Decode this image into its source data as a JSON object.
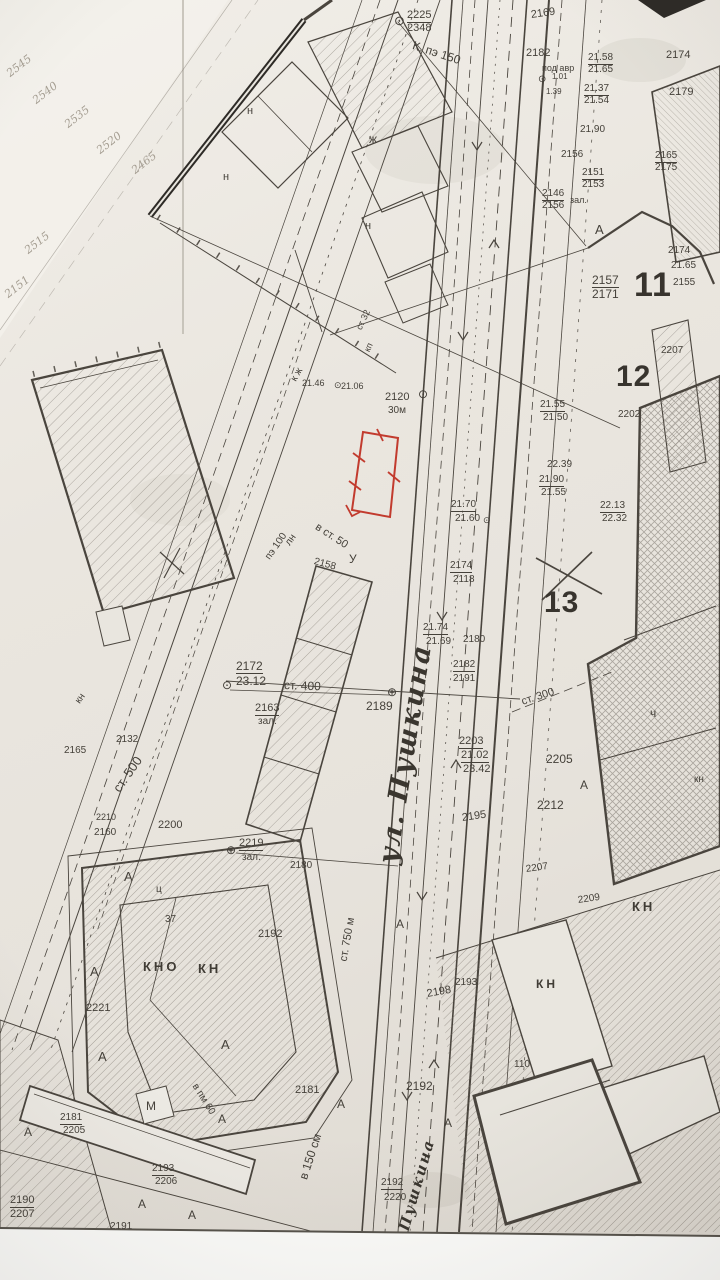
{
  "colors": {
    "paper": "#e9e6df",
    "paper_light": "#f3f1eb",
    "ink": "#45413a",
    "ink_faint": "#a49d91",
    "red": "#c23b2e",
    "margin": "#fcfcfa"
  },
  "map": {
    "streets": [
      {
        "t": "ул. Пушкина",
        "x": 388,
        "y": 866,
        "r": -81,
        "s": 27
      },
      {
        "t": "Пушкина",
        "x": 404,
        "y": 1232,
        "r": -74,
        "s": 15
      }
    ],
    "blocks": [
      {
        "t": "11",
        "x": 634,
        "y": 288,
        "s": 34
      },
      {
        "t": "12",
        "x": 616,
        "y": 380,
        "s": 30
      },
      {
        "t": "13",
        "x": 544,
        "y": 606,
        "s": 30
      }
    ],
    "labels": [
      {
        "t": "⊙",
        "x": 394,
        "y": 22,
        "s": 13,
        "c": "sym"
      },
      {
        "t": "2225",
        "x": 407,
        "y": 17,
        "u": 1
      },
      {
        "t": "2348",
        "x": 407,
        "y": 30
      },
      {
        "t": "К. пэ 150",
        "x": 413,
        "y": 46,
        "r": 18,
        "s": 12
      },
      {
        "t": "2169",
        "x": 531,
        "y": 17,
        "r": -8
      },
      {
        "t": "2182",
        "x": 526,
        "y": 55
      },
      {
        "t": "под авр",
        "x": 542,
        "y": 69,
        "s": 9
      },
      {
        "t": "⊙",
        "x": 538,
        "y": 81,
        "s": 10,
        "c": "sym"
      },
      {
        "t": "1.01",
        "x": 552,
        "y": 78,
        "s": 8
      },
      {
        "t": "1.39",
        "x": 546,
        "y": 93,
        "s": 8
      },
      {
        "t": "21.58",
        "x": 588,
        "y": 59,
        "s": 10,
        "u": 1
      },
      {
        "t": "21.65",
        "x": 588,
        "y": 71,
        "s": 10
      },
      {
        "t": "21.37",
        "x": 584,
        "y": 90,
        "s": 10,
        "u": 1
      },
      {
        "t": "21.54",
        "x": 584,
        "y": 102,
        "s": 10
      },
      {
        "t": "2174",
        "x": 666,
        "y": 57
      },
      {
        "t": "2179",
        "x": 669,
        "y": 94
      },
      {
        "t": "21.90",
        "x": 580,
        "y": 131,
        "s": 10
      },
      {
        "t": "2156",
        "x": 561,
        "y": 156,
        "s": 10
      },
      {
        "t": "2151",
        "x": 582,
        "y": 174,
        "s": 10,
        "u": 1
      },
      {
        "t": "2153",
        "x": 582,
        "y": 186,
        "s": 10
      },
      {
        "t": "2165",
        "x": 655,
        "y": 157,
        "s": 10,
        "u": 1
      },
      {
        "t": "2175",
        "x": 655,
        "y": 169,
        "s": 10
      },
      {
        "t": "2146",
        "x": 542,
        "y": 195,
        "s": 10,
        "u": 1
      },
      {
        "t": "2156",
        "x": 542,
        "y": 207,
        "s": 10
      },
      {
        "t": "зал.",
        "x": 570,
        "y": 201,
        "s": 9
      },
      {
        "t": "А",
        "x": 595,
        "y": 231,
        "s": 13
      },
      {
        "t": "2157",
        "x": 592,
        "y": 281,
        "s": 12,
        "u": 1
      },
      {
        "t": "2171",
        "x": 592,
        "y": 295,
        "s": 12
      },
      {
        "t": "2174",
        "x": 668,
        "y": 252,
        "s": 10
      },
      {
        "t": "21.65",
        "x": 671,
        "y": 267,
        "s": 10
      },
      {
        "t": "2155",
        "x": 673,
        "y": 284,
        "s": 10
      },
      {
        "t": "2120",
        "x": 385,
        "y": 399
      },
      {
        "t": "30м",
        "x": 388,
        "y": 412,
        "s": 10
      },
      {
        "t": "⊙",
        "x": 418,
        "y": 395,
        "s": 12,
        "c": "sym"
      },
      {
        "t": "21.70",
        "x": 451,
        "y": 506,
        "s": 10,
        "u": 1
      },
      {
        "t": "21.60",
        "x": 455,
        "y": 520,
        "s": 10
      },
      {
        "t": "⊙",
        "x": 483,
        "y": 521,
        "s": 9,
        "c": "sym"
      },
      {
        "t": "2207",
        "x": 661,
        "y": 352,
        "s": 10
      },
      {
        "t": "21.55",
        "x": 540,
        "y": 406,
        "s": 10,
        "u": 1
      },
      {
        "t": "21.50",
        "x": 543,
        "y": 419,
        "s": 10
      },
      {
        "t": "2202",
        "x": 618,
        "y": 416,
        "s": 10
      },
      {
        "t": "22.39",
        "x": 547,
        "y": 466,
        "s": 10
      },
      {
        "t": "21.90",
        "x": 539,
        "y": 481,
        "s": 10,
        "u": 1
      },
      {
        "t": "21.55",
        "x": 541,
        "y": 494,
        "s": 10
      },
      {
        "t": "22.13",
        "x": 600,
        "y": 507,
        "s": 10,
        "u": 1
      },
      {
        "t": "22.32",
        "x": 602,
        "y": 520,
        "s": 10
      },
      {
        "t": "2174",
        "x": 450,
        "y": 567,
        "s": 10,
        "u": 1
      },
      {
        "t": "2118",
        "x": 453,
        "y": 581,
        "s": 10
      },
      {
        "t": "21.74",
        "x": 423,
        "y": 629,
        "s": 10,
        "u": 1
      },
      {
        "t": "21.69",
        "x": 426,
        "y": 643,
        "s": 10
      },
      {
        "t": "2180",
        "x": 463,
        "y": 641,
        "s": 10
      },
      {
        "t": "2182",
        "x": 453,
        "y": 666,
        "s": 10,
        "u": 1
      },
      {
        "t": "2191",
        "x": 453,
        "y": 680,
        "s": 10
      },
      {
        "t": "⊕",
        "x": 387,
        "y": 693,
        "s": 12,
        "c": "sym"
      },
      {
        "t": "2189",
        "x": 366,
        "y": 707,
        "s": 12
      },
      {
        "t": "2172",
        "x": 236,
        "y": 667,
        "s": 12,
        "u": 1
      },
      {
        "t": "23.12",
        "x": 236,
        "y": 682,
        "s": 12
      },
      {
        "t": "⊙",
        "x": 222,
        "y": 686,
        "s": 12,
        "c": "sym"
      },
      {
        "t": "ст. 400",
        "x": 284,
        "y": 686,
        "r": 2,
        "s": 12
      },
      {
        "t": "2163",
        "x": 255,
        "y": 710,
        "u": 1
      },
      {
        "t": "зал.",
        "x": 258,
        "y": 723,
        "s": 10
      },
      {
        "t": "ст. 300",
        "x": 522,
        "y": 704,
        "r": -18,
        "s": 11
      },
      {
        "t": "2203",
        "x": 459,
        "y": 743,
        "u": 1
      },
      {
        "t": "21.02",
        "x": 461,
        "y": 757,
        "u": 1
      },
      {
        "t": "23.42",
        "x": 463,
        "y": 771
      },
      {
        "t": "2205",
        "x": 546,
        "y": 760,
        "s": 12
      },
      {
        "t": "2212",
        "x": 537,
        "y": 806,
        "s": 12
      },
      {
        "t": "ч",
        "x": 650,
        "y": 714,
        "s": 12
      },
      {
        "t": "кн",
        "x": 694,
        "y": 781,
        "s": 10
      },
      {
        "t": "А",
        "x": 580,
        "y": 786,
        "s": 12
      },
      {
        "t": "2195",
        "x": 462,
        "y": 820,
        "r": -8
      },
      {
        "t": "2207",
        "x": 526,
        "y": 871,
        "s": 10,
        "r": -8
      },
      {
        "t": "2209",
        "x": 578,
        "y": 902,
        "s": 10,
        "r": -8
      },
      {
        "t": "КН",
        "x": 632,
        "y": 908,
        "s": 13,
        "c": "sp"
      },
      {
        "t": "⊕",
        "x": 226,
        "y": 851,
        "s": 12,
        "c": "sym"
      },
      {
        "t": "2219",
        "x": 239,
        "y": 845,
        "u": 1
      },
      {
        "t": "зал.",
        "x": 242,
        "y": 859,
        "s": 10
      },
      {
        "t": "2180",
        "x": 290,
        "y": 867,
        "s": 10
      },
      {
        "t": "2192",
        "x": 258,
        "y": 936
      },
      {
        "t": "37",
        "x": 165,
        "y": 921,
        "s": 10
      },
      {
        "t": "КНО",
        "x": 143,
        "y": 968,
        "s": 13,
        "c": "sp"
      },
      {
        "t": "КН",
        "x": 198,
        "y": 970,
        "s": 13,
        "c": "sp"
      },
      {
        "t": "ц",
        "x": 156,
        "y": 891,
        "s": 10
      },
      {
        "t": "А",
        "x": 124,
        "y": 878,
        "s": 13
      },
      {
        "t": "А",
        "x": 90,
        "y": 973,
        "s": 13
      },
      {
        "t": "А",
        "x": 98,
        "y": 1058,
        "s": 13
      },
      {
        "t": "А",
        "x": 221,
        "y": 1046,
        "s": 13
      },
      {
        "t": "2221",
        "x": 86,
        "y": 1010
      },
      {
        "t": "А",
        "x": 396,
        "y": 925,
        "s": 12
      },
      {
        "t": "ст. 750 м",
        "x": 344,
        "y": 963,
        "r": -80,
        "s": 11
      },
      {
        "t": "в 150 см",
        "x": 303,
        "y": 1180,
        "r": -72,
        "s": 12
      },
      {
        "t": "2181",
        "x": 295,
        "y": 1092
      },
      {
        "t": "А",
        "x": 337,
        "y": 1105,
        "s": 12
      },
      {
        "t": "2192",
        "x": 406,
        "y": 1087,
        "s": 12
      },
      {
        "t": "А",
        "x": 444,
        "y": 1124,
        "s": 12
      },
      {
        "t": "2192",
        "x": 381,
        "y": 1184,
        "s": 10,
        "u": 1
      },
      {
        "t": "2220",
        "x": 384,
        "y": 1199,
        "s": 10
      },
      {
        "t": "2198",
        "x": 427,
        "y": 996,
        "r": -10
      },
      {
        "t": "2193",
        "x": 455,
        "y": 984,
        "s": 10
      },
      {
        "t": "110",
        "x": 514,
        "y": 1066,
        "s": 10
      },
      {
        "t": "КН",
        "x": 536,
        "y": 985,
        "s": 12,
        "c": "sp"
      },
      {
        "t": "кн",
        "x": 78,
        "y": 704,
        "r": -55,
        "s": 10
      },
      {
        "t": "ст. 500",
        "x": 116,
        "y": 792,
        "r": -55,
        "s": 13
      },
      {
        "t": "2132",
        "x": 116,
        "y": 741,
        "s": 10
      },
      {
        "t": "2165",
        "x": 64,
        "y": 752,
        "s": 10
      },
      {
        "t": "2210",
        "x": 96,
        "y": 818,
        "s": 9
      },
      {
        "t": "2160",
        "x": 94,
        "y": 834,
        "s": 10
      },
      {
        "t": "2200",
        "x": 158,
        "y": 827
      },
      {
        "t": "пэ 100",
        "x": 268,
        "y": 560,
        "r": -55,
        "s": 10
      },
      {
        "t": "лн",
        "x": 288,
        "y": 546,
        "r": -55,
        "s": 10
      },
      {
        "t": "в ст. 50",
        "x": 316,
        "y": 528,
        "r": 33,
        "s": 11
      },
      {
        "t": "2158",
        "x": 314,
        "y": 563,
        "r": 15,
        "s": 10
      },
      {
        "t": "У",
        "x": 349,
        "y": 560,
        "s": 12
      },
      {
        "t": "к ж",
        "x": 294,
        "y": 382,
        "r": -60,
        "s": 10
      },
      {
        "t": "21.46",
        "x": 302,
        "y": 384,
        "s": 9
      },
      {
        "t": "⊙",
        "x": 334,
        "y": 386,
        "s": 9,
        "c": "sym"
      },
      {
        "t": "21.06",
        "x": 341,
        "y": 387,
        "s": 9
      },
      {
        "t": "ст 32",
        "x": 359,
        "y": 330,
        "r": -65,
        "s": 9
      },
      {
        "t": "кп",
        "x": 367,
        "y": 352,
        "r": -65,
        "s": 9
      },
      {
        "t": "н",
        "x": 247,
        "y": 113,
        "s": 11
      },
      {
        "t": "н",
        "x": 223,
        "y": 179,
        "s": 11
      },
      {
        "t": "ж",
        "x": 369,
        "y": 140,
        "s": 12
      },
      {
        "t": "н",
        "x": 365,
        "y": 228,
        "s": 11
      },
      {
        "t": "2545",
        "x": 8,
        "y": 76,
        "r": -38,
        "c": "faint"
      },
      {
        "t": "2540",
        "x": 34,
        "y": 103,
        "r": -38,
        "c": "faint"
      },
      {
        "t": "2535",
        "x": 66,
        "y": 127,
        "r": -38,
        "c": "faint"
      },
      {
        "t": "2520",
        "x": 98,
        "y": 153,
        "r": -38,
        "c": "faint"
      },
      {
        "t": "2465",
        "x": 133,
        "y": 173,
        "r": -38,
        "c": "faint"
      },
      {
        "t": "2515",
        "x": 26,
        "y": 253,
        "r": -38,
        "c": "faint"
      },
      {
        "t": "2151",
        "x": 6,
        "y": 297,
        "r": -38,
        "c": "faint"
      },
      {
        "t": "2190",
        "x": 10,
        "y": 1202,
        "u": 1
      },
      {
        "t": "2207",
        "x": 10,
        "y": 1216
      },
      {
        "t": "2181",
        "x": 60,
        "y": 1119,
        "s": 10,
        "u": 1
      },
      {
        "t": "2205",
        "x": 63,
        "y": 1132,
        "s": 10
      },
      {
        "t": "М",
        "x": 146,
        "y": 1107,
        "s": 12
      },
      {
        "t": "2193",
        "x": 152,
        "y": 1170,
        "s": 10,
        "u": 1
      },
      {
        "t": "2206",
        "x": 155,
        "y": 1183,
        "s": 10
      },
      {
        "t": "2191",
        "x": 110,
        "y": 1228,
        "s": 10
      },
      {
        "t": "А",
        "x": 24,
        "y": 1133,
        "s": 12
      },
      {
        "t": "А",
        "x": 138,
        "y": 1205,
        "s": 12
      },
      {
        "t": "А",
        "x": 188,
        "y": 1216,
        "s": 12
      },
      {
        "t": "А",
        "x": 218,
        "y": 1120,
        "s": 12
      },
      {
        "t": "в пм 60",
        "x": 194,
        "y": 1086,
        "r": 58,
        "s": 10
      }
    ]
  }
}
